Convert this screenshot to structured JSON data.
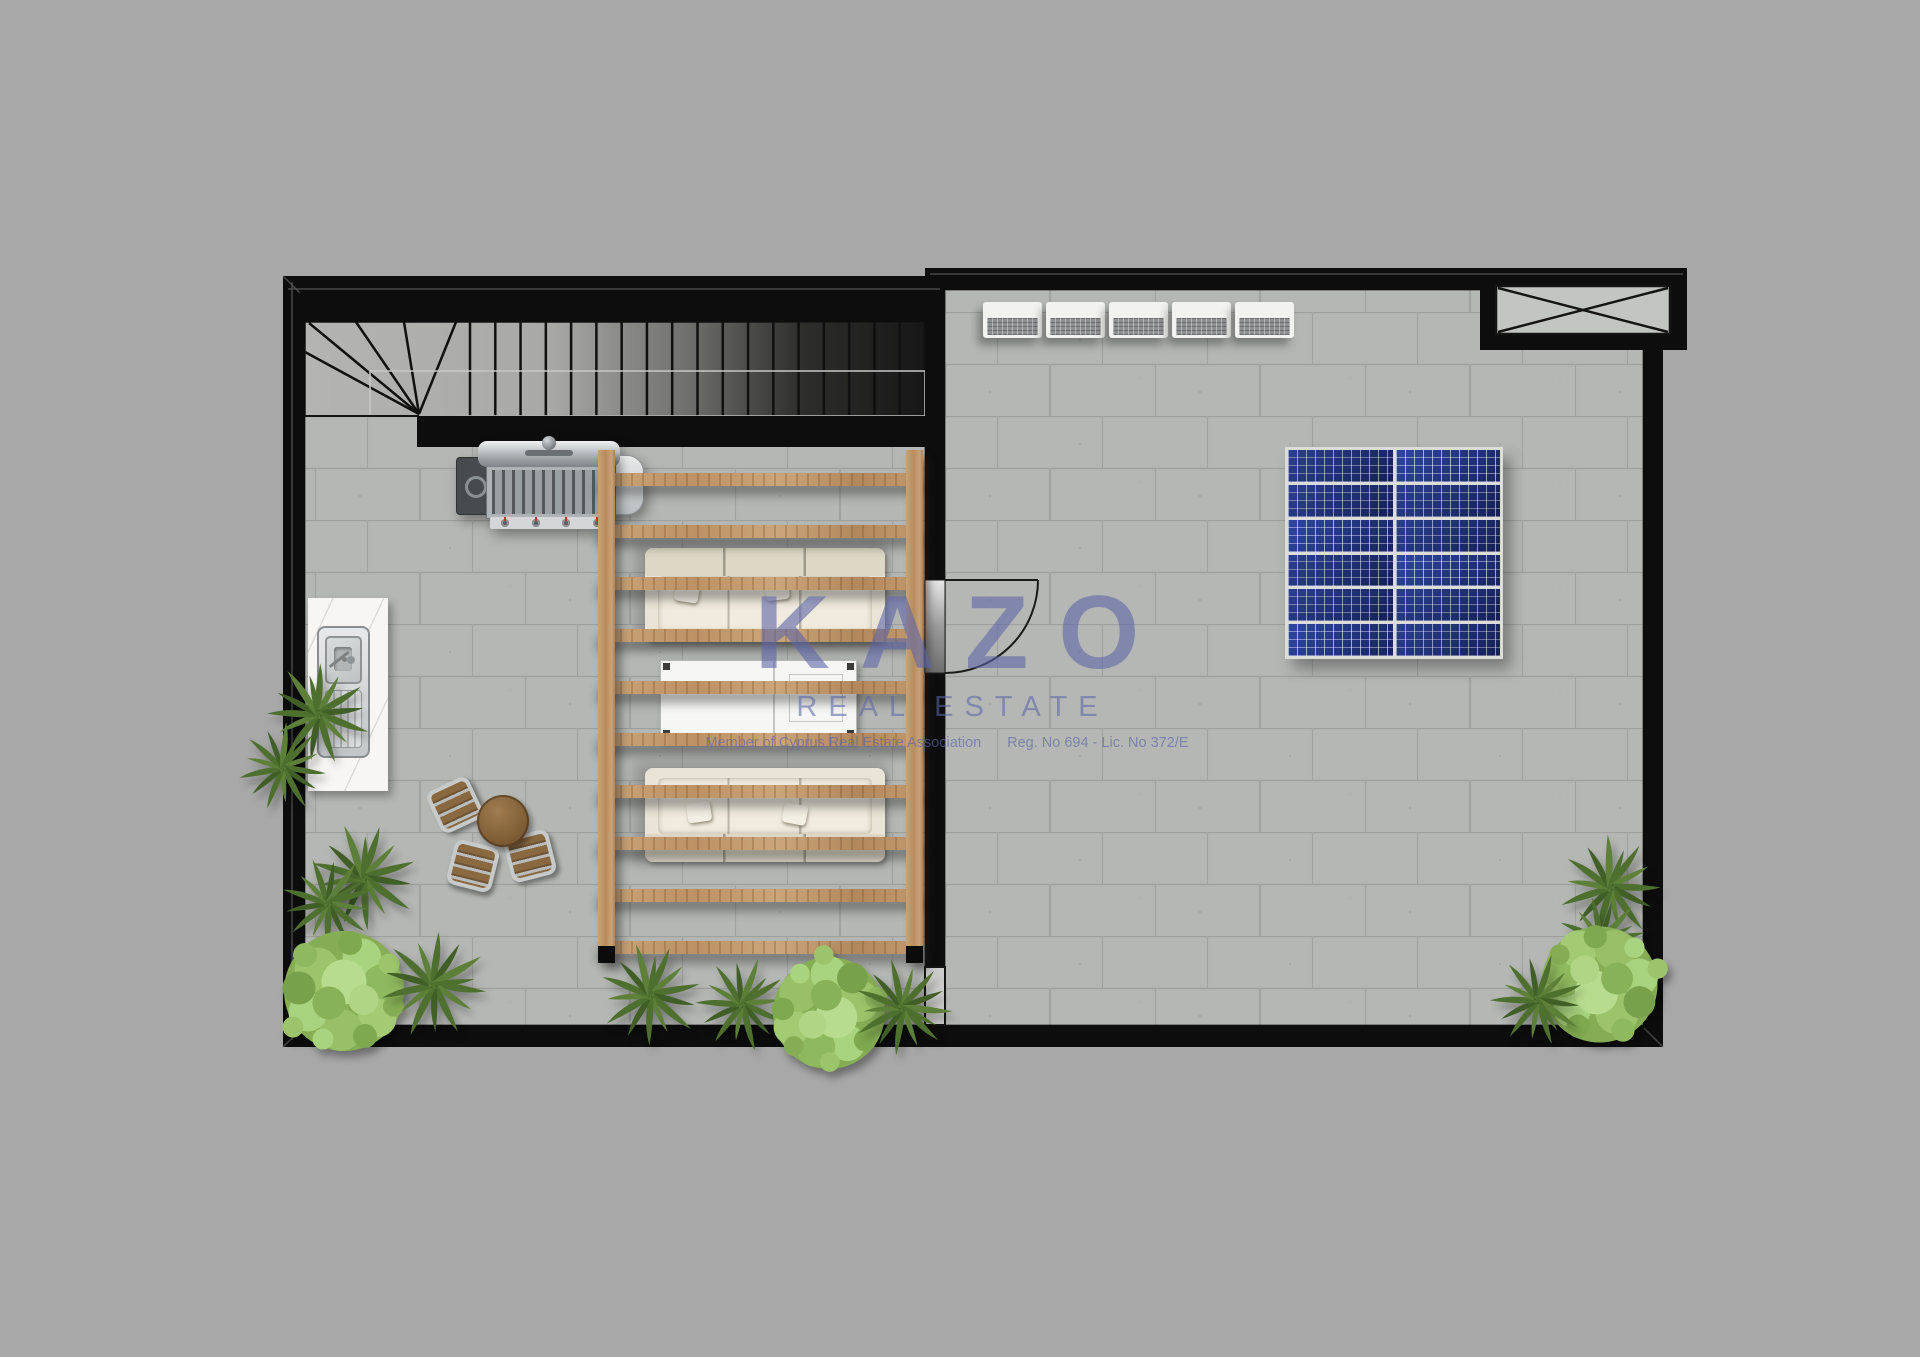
{
  "meta": {
    "document_type": "roof-terrace-floor-plan",
    "brand": "KAZO"
  },
  "watermark": {
    "logo": "KAZO",
    "subtitle": "REAL ESTATE",
    "member_line": "Member of Cyprus Real Estate Association",
    "registration_line": "Reg. No 694 - Lic. No 372/E"
  },
  "palette": {
    "background": "#a8a8a8",
    "wall": "#0d0d0d",
    "floor_tile": "#b7b9b6",
    "tile_line": "#9da09c",
    "wood": "#c6a071",
    "sofa": "#e9e4d6",
    "solar_blue": "#1d2d6e",
    "plant_dark": "#4e702f",
    "plant_light": "#9dc36a",
    "counter": "#f7f6f4",
    "steel": "#c9cbcc",
    "watermark": "#5d66a8"
  },
  "objects": {
    "staircase": {
      "straight_treads": 18,
      "winder_treads": 5
    },
    "pergola": {
      "beams": 10
    },
    "hvac_units": {
      "count": 5
    },
    "solar_array": {
      "columns": 2,
      "rows": 6
    },
    "seating": {
      "sofas": 2,
      "coffee_tables": 1
    },
    "dining": {
      "chairs": 3,
      "tables": 1
    },
    "kitchen": {
      "bbq_grills": 1,
      "sinks": 1
    },
    "openings": {
      "doors": 1,
      "roof_hatches": 1
    },
    "plants": {
      "spiky": 11,
      "bushes": 3
    }
  }
}
